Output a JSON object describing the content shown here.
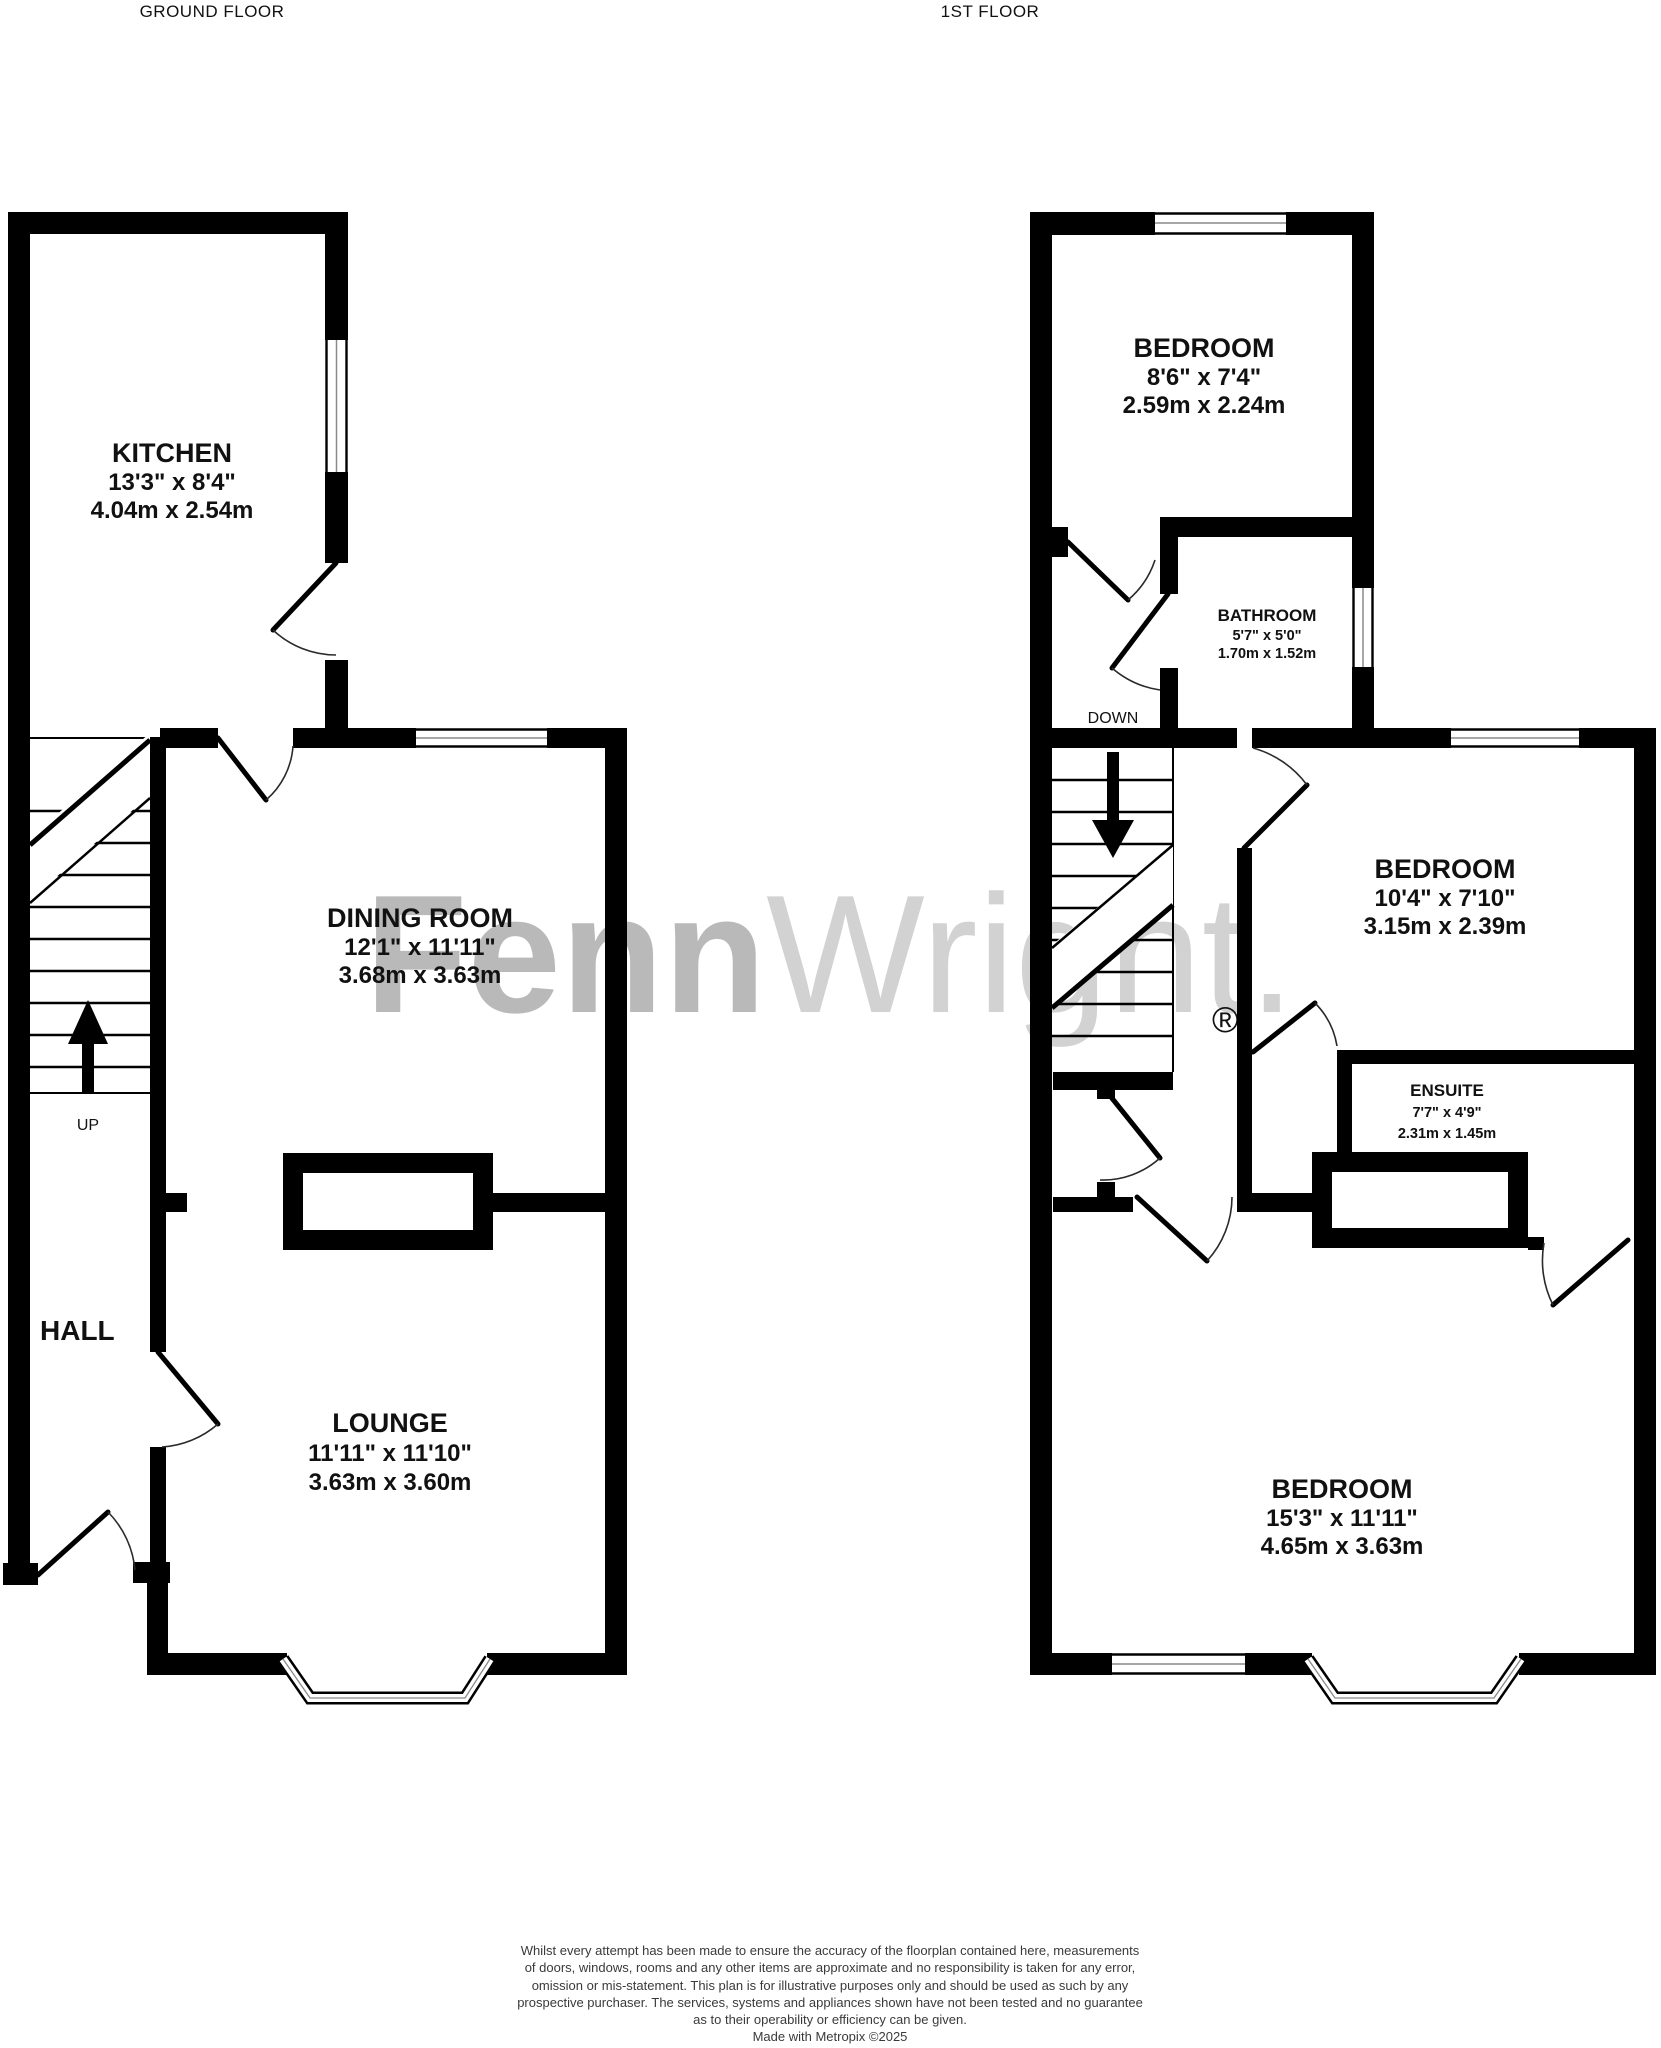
{
  "page": {
    "background": "#ffffff",
    "wall_color": "#000000",
    "watermark_bold_color": "#b9b9b9",
    "watermark_light_color": "#d2d2d2"
  },
  "titles": {
    "ground": "GROUND FLOOR",
    "first": "1ST FLOOR"
  },
  "watermark": {
    "part1": "Fenn",
    "part2": "Wright.",
    "registered": "®"
  },
  "floors": [
    {
      "name": "GROUND FLOOR",
      "stair_label": "UP",
      "rooms": [
        {
          "key": "kitchen",
          "name": "KITCHEN",
          "imperial": "13'3\"  x 8'4\"",
          "metric": "4.04m  x 2.54m"
        },
        {
          "key": "dining-room",
          "name": "DINING ROOM",
          "imperial": "12'1\"  x 11'11\"",
          "metric": "3.68m  x 3.63m"
        },
        {
          "key": "lounge",
          "name": "LOUNGE",
          "imperial": "11'11\"  x 11'10\"",
          "metric": "3.63m  x 3.60m"
        },
        {
          "key": "hall",
          "name": "HALL",
          "imperial": "",
          "metric": ""
        }
      ]
    },
    {
      "name": "1ST FLOOR",
      "stair_label": "DOWN",
      "rooms": [
        {
          "key": "bedroom-rear",
          "name": "BEDROOM",
          "imperial": "8'6\"  x 7'4\"",
          "metric": "2.59m  x 2.24m"
        },
        {
          "key": "bathroom",
          "name": "BATHROOM",
          "imperial": "5'7\"  x 5'0\"",
          "metric": "1.70m  x 1.52m"
        },
        {
          "key": "bedroom-middle",
          "name": "BEDROOM",
          "imperial": "10'4\"  x 7'10\"",
          "metric": "3.15m  x 2.39m"
        },
        {
          "key": "ensuite",
          "name": "ENSUITE",
          "imperial": "7'7\"  x 4'9\"",
          "metric": "2.31m  x 1.45m"
        },
        {
          "key": "bedroom-front",
          "name": "BEDROOM",
          "imperial": "15'3\"  x 11'11\"",
          "metric": "4.65m  x 3.63m"
        }
      ]
    }
  ],
  "disclaimer": {
    "lines": [
      "Whilst every attempt has been made to ensure the accuracy of the floorplan contained here, measurements",
      "of doors, windows, rooms and any other items are approximate and no responsibility is taken for any error,",
      "omission or mis-statement. This plan is for illustrative purposes only and should be used as such by any",
      "prospective purchaser. The services, systems and appliances shown have not been tested and no guarantee",
      "as to their operability or efficiency can be given.",
      "Made with Metropix ©2025"
    ]
  }
}
